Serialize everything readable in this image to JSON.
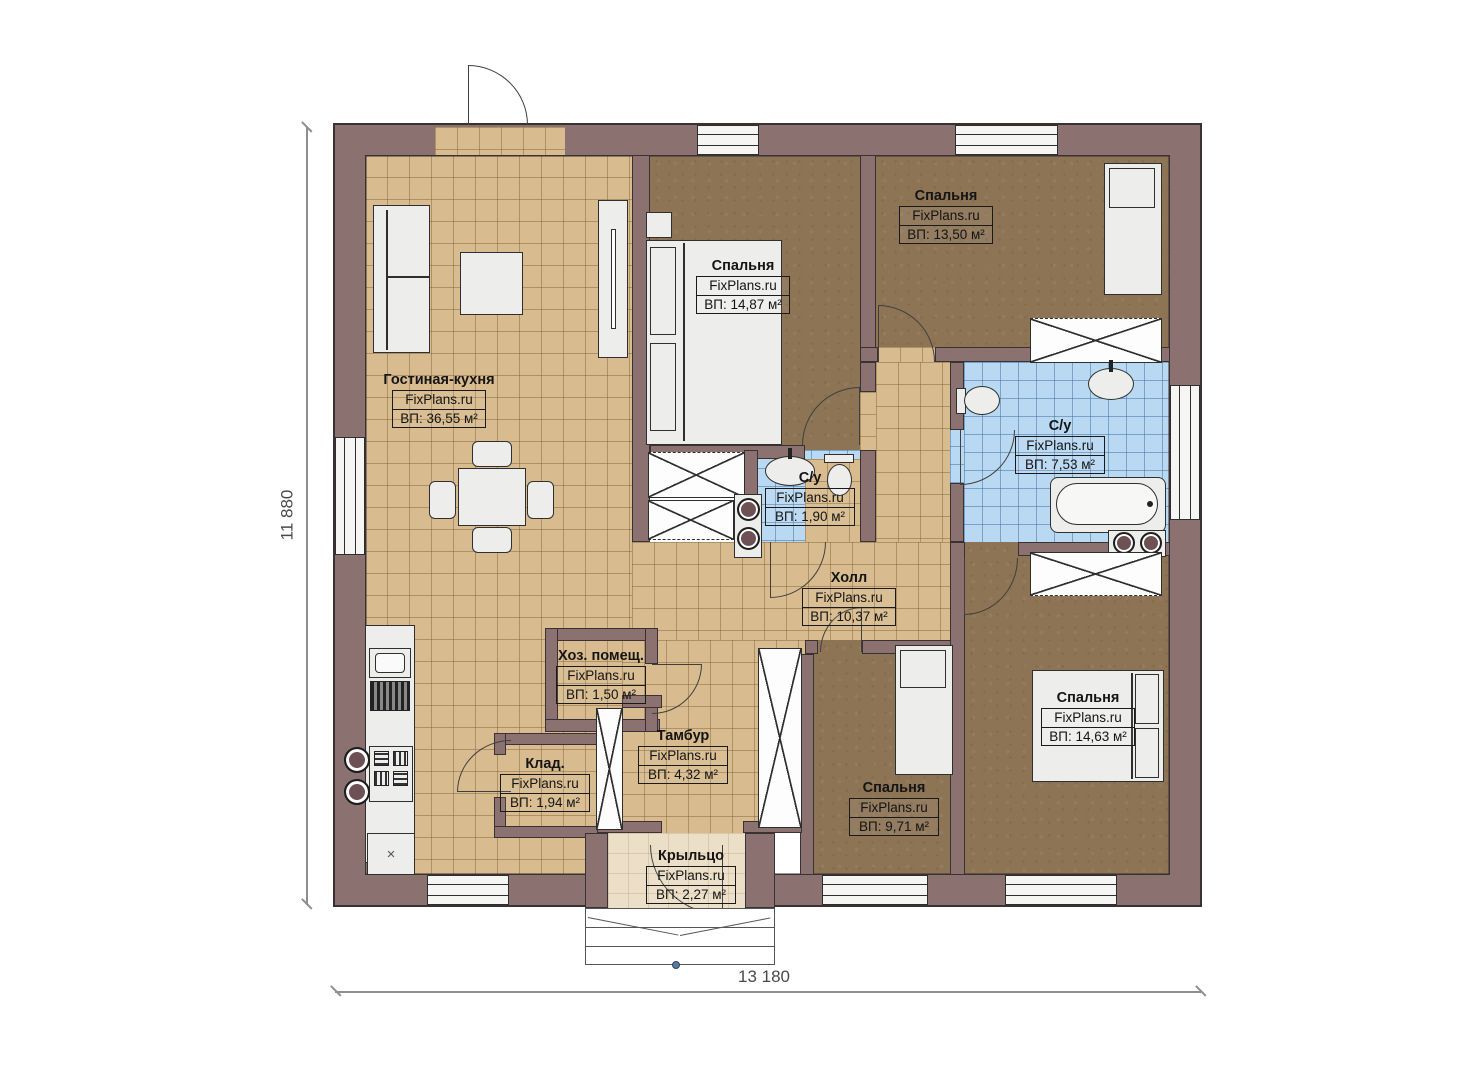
{
  "plan": {
    "watermark": "FixPlans.ru",
    "dim_height": "11 880",
    "dim_width": "13 180",
    "symbols": {
      "cabinet_x": "×"
    },
    "colors": {
      "wall": "#8b7170",
      "wall_outline": "#3a3132",
      "tile_beige": "#d8bb8e",
      "floor_brown": "#8d7455",
      "tile_blue": "#b9d8f2",
      "porch_cream": "#ecdfc7",
      "furniture": "#ededeb"
    },
    "rooms": [
      {
        "name": "Гостиная-кухня",
        "area": "ВП: 36,55 м²"
      },
      {
        "name": "Спальня",
        "area": "ВП: 14,87 м²"
      },
      {
        "name": "Спальня",
        "area": "ВП: 13,50 м²"
      },
      {
        "name": "С/у",
        "area": "ВП: 7,53 м²"
      },
      {
        "name": "С/у",
        "area": "ВП: 1,90 м²"
      },
      {
        "name": "Холл",
        "area": "ВП: 10,37 м²"
      },
      {
        "name": "Хоз. помещ.",
        "area": "ВП: 1,50 м²"
      },
      {
        "name": "Клад.",
        "area": "ВП: 1,94 м²"
      },
      {
        "name": "Тамбур",
        "area": "ВП: 4,32 м²"
      },
      {
        "name": "Спальня",
        "area": "ВП: 9,71 м²"
      },
      {
        "name": "Спальня",
        "area": "ВП: 14,63 м²"
      },
      {
        "name": "Крыльцо",
        "area": "ВП: 2,27 м²"
      }
    ]
  }
}
